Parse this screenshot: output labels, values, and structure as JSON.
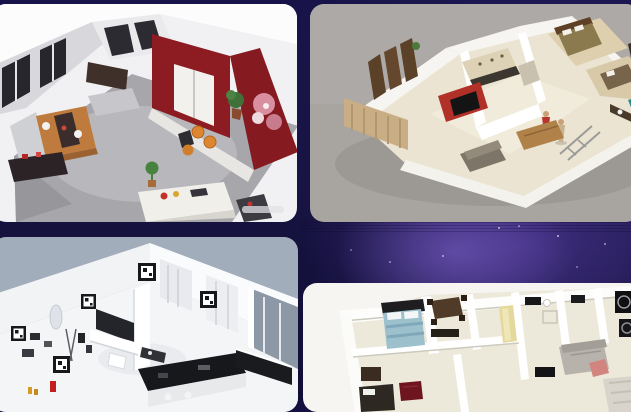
{
  "screen": {
    "name": "3d-floor-plan-gallery",
    "background": {
      "base_color": "#141140",
      "glow_color": "#6a4fc0",
      "star_color": "#dbd6f8"
    }
  },
  "gallery": {
    "cards": [
      {
        "id": "card-1",
        "alt": "3D render of an open-plan living and dining room with dark red accent walls, wooden dining table, orange stools and a white kitchen island",
        "bg_color": "#f1f1f3",
        "accent_color": "#8d1c22"
      },
      {
        "id": "card-2",
        "alt": "Isometric 3D floor plan of a house with cream floors, wooden doors, a staircase, a red kitchen media wall and furnished bedrooms",
        "bg_color": "#a8a4a0",
        "accent_color": "#b13028"
      },
      {
        "id": "card-3",
        "alt": "Monochrome 3D apartment render in white with black framed artwork, black kitchen island and a glass wall",
        "bg_color": "#a2adbc",
        "accent_color": "#17181b"
      },
      {
        "id": "card-4",
        "alt": "Top-down 3D floor plan of a two-bedroom apartment with a blue bed, dark red rug, yellow hallway wall and gray sofa",
        "bg_color": "#f6f5f2",
        "accent_color": "#9dc0cd"
      }
    ]
  }
}
